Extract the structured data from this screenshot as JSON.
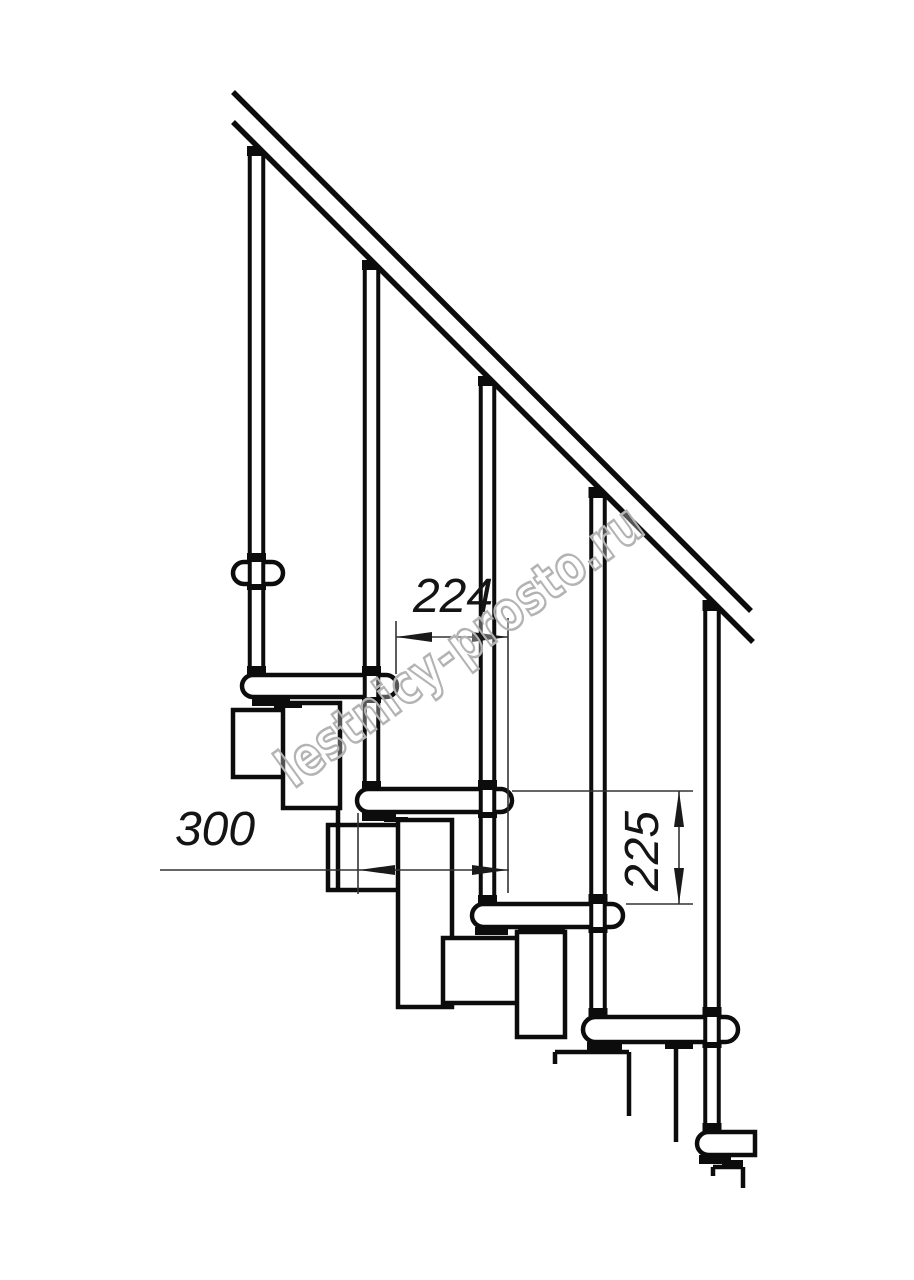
{
  "canvas": {
    "w": 914,
    "h": 1280,
    "bg": "#ffffff",
    "line_color": "#0c0c0c",
    "thin_color": "#333333"
  },
  "watermark": {
    "text": "lestnicy-prosto.ru"
  },
  "dimensions": {
    "labels": [
      {
        "id": "dim-224",
        "text": "224",
        "left": 398,
        "top": 573,
        "vertical": false
      },
      {
        "id": "dim-300",
        "text": "300",
        "left": 160,
        "top": 806,
        "vertical": false
      },
      {
        "id": "dim-225",
        "text": "225",
        "left": 588,
        "top": 827,
        "vertical": true
      }
    ]
  },
  "geometry": {
    "rail_band": "233,92 751,611 753,642 233,122",
    "rail_lines": [
      [
        233,
        92,
        751,
        611
      ],
      [
        233,
        122,
        753,
        642
      ]
    ],
    "rail_stroke": 5.5,
    "modules": [
      [
        233,
        710,
        55,
        67
      ],
      [
        283,
        703,
        57,
        105
      ],
      [
        328,
        825,
        75,
        65
      ],
      [
        398,
        820,
        54,
        187
      ],
      [
        443,
        938,
        75,
        65
      ],
      [
        517,
        932,
        48,
        105
      ]
    ],
    "chain_lines": [
      [
        338,
        808,
        338,
        888
      ],
      [
        555,
        1052,
        629,
        1052
      ],
      [
        555,
        1052,
        555,
        1064
      ],
      [
        629,
        1052,
        629,
        1116
      ],
      [
        676,
        1042,
        676,
        1142
      ],
      [
        713,
        1167,
        743,
        1167
      ],
      [
        713,
        1167,
        713,
        1176
      ],
      [
        743,
        1167,
        743,
        1188
      ]
    ],
    "brackets": [
      [
        252,
        697,
        38,
        9
      ],
      [
        274,
        703,
        28,
        5
      ],
      [
        362,
        812,
        34,
        9
      ],
      [
        384,
        817,
        24,
        5
      ],
      [
        475,
        927,
        33,
        8
      ],
      [
        518,
        927,
        47,
        6
      ],
      [
        587,
        1042,
        35,
        8
      ],
      [
        665,
        1042,
        28,
        7
      ],
      [
        699,
        1155,
        32,
        9
      ],
      [
        722,
        1160,
        21,
        5
      ]
    ],
    "treads": [
      [
        233,
        562,
        50,
        22,
        1,
        1
      ],
      [
        242,
        675,
        155,
        22,
        1,
        1
      ],
      [
        357,
        789,
        155,
        23,
        1,
        1
      ],
      [
        472,
        904,
        151,
        23,
        1,
        1
      ],
      [
        583,
        1017,
        155,
        25,
        1,
        1
      ],
      [
        697,
        1132,
        58,
        23,
        1,
        0
      ]
    ],
    "tread_stroke": 4.5,
    "balusters": [
      {
        "cx": 256.5,
        "top": 156,
        "bottom": 667,
        "collars": [
          [
            146,
            10
          ],
          [
            553,
            9
          ],
          [
            584,
            6
          ],
          [
            666,
            10
          ]
        ]
      },
      {
        "cx": 371.5,
        "top": 270,
        "bottom": 782,
        "collars": [
          [
            260,
            10
          ],
          [
            666,
            10
          ],
          [
            697,
            6
          ],
          [
            781,
            9
          ]
        ]
      },
      {
        "cx": 487.5,
        "top": 386,
        "bottom": 896,
        "collars": [
          [
            376,
            10
          ],
          [
            780,
            10
          ],
          [
            812,
            6
          ],
          [
            895,
            9
          ]
        ]
      },
      {
        "cx": 598.0,
        "top": 498,
        "bottom": 1009,
        "collars": [
          [
            487,
            11
          ],
          [
            894,
            10
          ],
          [
            927,
            6
          ],
          [
            1008,
            9
          ]
        ]
      },
      {
        "cx": 712.0,
        "top": 611,
        "bottom": 1124,
        "collars": [
          [
            600,
            11
          ],
          [
            1007,
            10
          ],
          [
            1042,
            6
          ],
          [
            1123,
            9
          ]
        ]
      }
    ],
    "baluster_half_width": 6.75,
    "baluster_stroke": 4,
    "collar_half_width": 9.5,
    "dim_ext_lines": [
      [
        396,
        621,
        396,
        674
      ],
      [
        508,
        618,
        508,
        893
      ],
      [
        358,
        813,
        358,
        894
      ],
      [
        512,
        791,
        693,
        791
      ],
      [
        626,
        904,
        693,
        904
      ]
    ],
    "dim_lines": [
      [
        396,
        637,
        508,
        637
      ],
      [
        160,
        870,
        509,
        870
      ],
      [
        679,
        791,
        679,
        904
      ]
    ],
    "arrows": [
      {
        "tip": [
          396,
          637
        ],
        "dir": "left"
      },
      {
        "tip": [
          508,
          637
        ],
        "dir": "right"
      },
      {
        "tip": [
          359,
          870
        ],
        "dir": "left"
      },
      {
        "tip": [
          508,
          870
        ],
        "dir": "right"
      },
      {
        "tip": [
          679,
          791
        ],
        "dir": "up"
      },
      {
        "tip": [
          679,
          904
        ],
        "dir": "down"
      }
    ],
    "arrow_len": 36,
    "arrow_half": 5,
    "thin_stroke": 1.6
  }
}
